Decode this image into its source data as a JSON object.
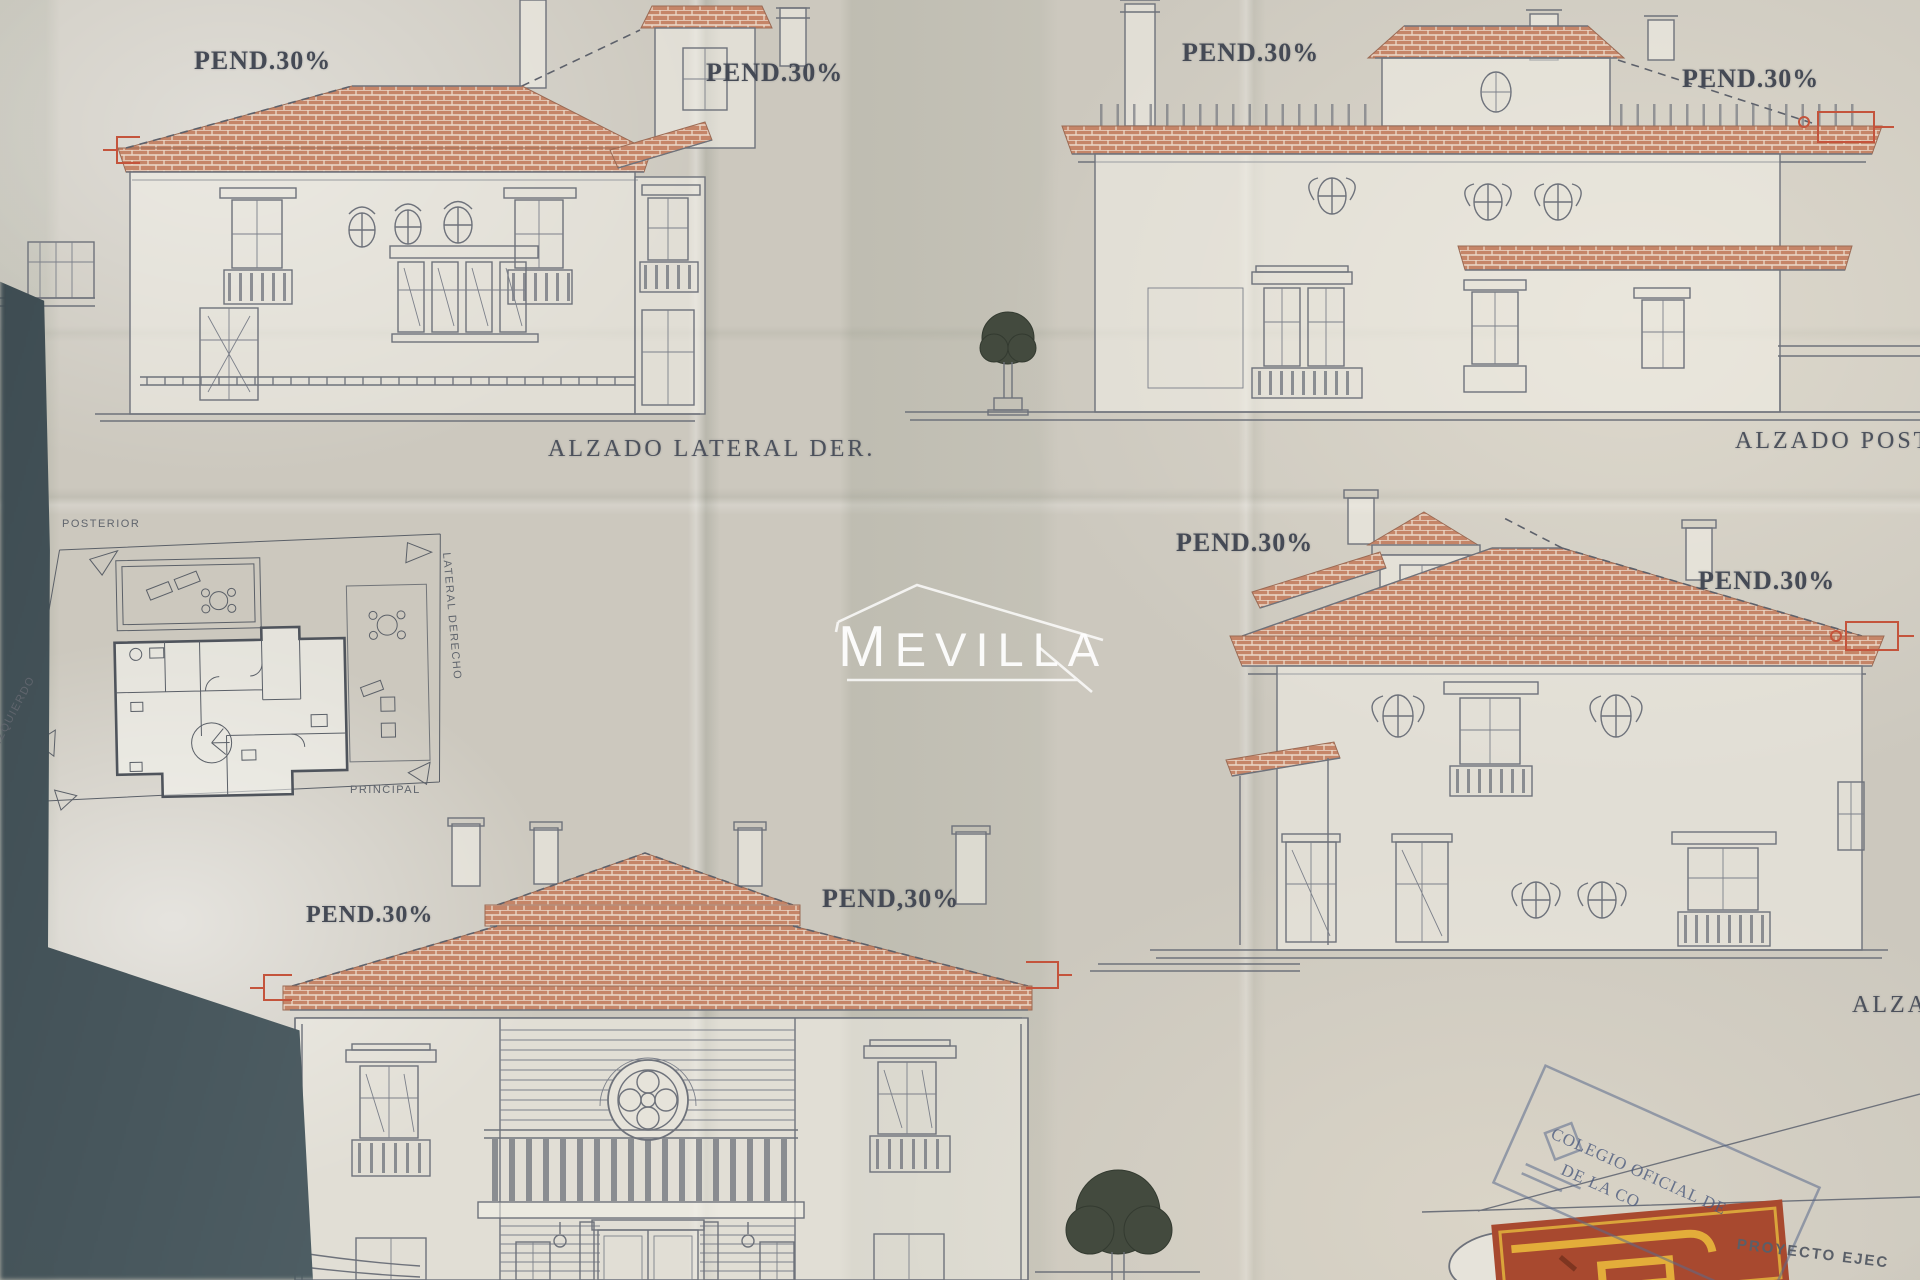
{
  "watermark": {
    "text": "MEVILLA"
  },
  "elevations": {
    "top_left": {
      "pend_left": "PEND.30%",
      "pend_right": "PEND.30%",
      "title": "ALZADO LATERAL DER."
    },
    "top_right": {
      "pend_left": "PEND.30%",
      "pend_right": "PEND.30%",
      "title": "ALZADO POSTE"
    },
    "middle_right": {
      "pend_left": "PEND.30%",
      "pend_right": "PEND.30%",
      "title": "ALZA"
    },
    "bottom": {
      "pend_left": "PEND.30%",
      "pend_right": "PEND,30%"
    }
  },
  "floor_plan": {
    "label_posterior": "POSTERIOR",
    "label_lateral_derecho": "LATERAL DERECHO",
    "label_principal": "PRINCIPAL",
    "label_lateral_izquierdo": "IZQUIERDO"
  },
  "stamp": {
    "line1": "COLEGIO OFICIAL DE",
    "line2": "DE LA CO",
    "project_label": "PROYECTO EJEC"
  },
  "colors": {
    "paper": "#ccc8be",
    "line_ink": "#6e727b",
    "roof_tile": "#c58568",
    "tile_joint": "#ecd9c9",
    "text_ink": "#454a55",
    "red_dimension": "#c4543c",
    "watermark_white": "#ffffff",
    "stamp_blue": "#5f7093",
    "stamp_red": "#a8492f",
    "stamp_yellow": "#e0b03c",
    "corner_shadow": "#4a5a60"
  }
}
